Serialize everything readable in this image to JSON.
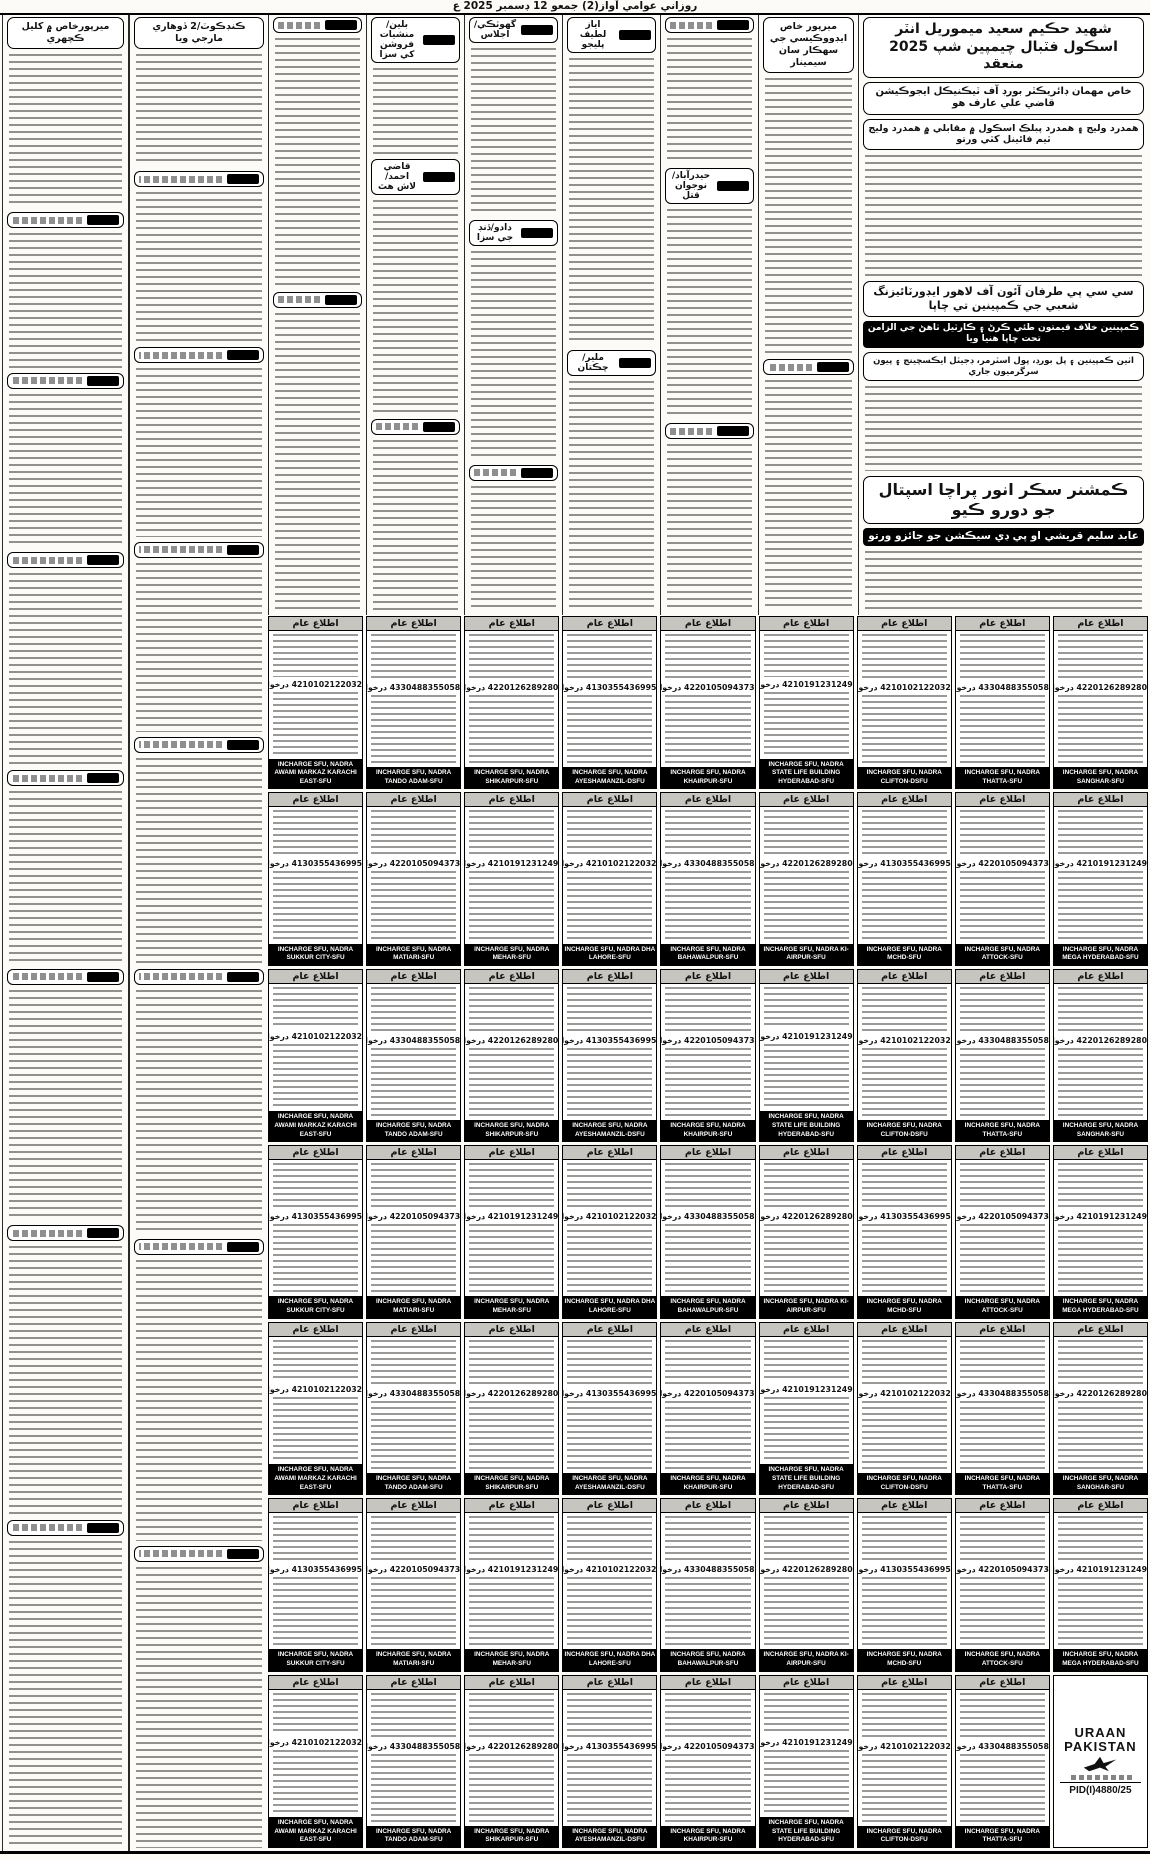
{
  "masthead": {
    "title": "روزاني عوامي آواز(2) جمعو 12 ڊسمبر 2025 ع"
  },
  "colors": {
    "ink": "#121212",
    "paper": "#fcfbf7",
    "notice_header_bg": "#c7c5bf",
    "footer_bg": "#000000"
  },
  "right_top": {
    "headline": "شهيد حڪيم سعيد ميموريل انٽر اسڪول فٽبال چيمپين شپ 2025 منعقد",
    "sub1": "خاص مهمان ڊائريڪٽر بورڊ آف ٽيڪنيڪل ايجوڪيشن قاضي علي عارف هو",
    "sub2": "همدرد وليج ۽ همدرد پبلڪ اسڪول ۾ مقابلي ۾ همدرد وليج ٽيم فائينل کٽي ورتو"
  },
  "right_mid": {
    "headline": "سي سي پي طرفان آئون آف لاهور ايڊورٽائيزنگ شعبي جي ڪمپينين تي چاپا",
    "sub1": "ڪمپينين خلاف قيمتون طئي ڪرڻ ۽ ڪارٽيل ٺاهڻ جي الزامن تحت چاپا هنيا ويا",
    "sub2": "اٺين ڪمپينين ۽ پل بورڊ، پول اسٽرمر، ڊجيٽل ايڪسچينج ۽ پيون سرگرميون جاري"
  },
  "right_bottom": {
    "headline": "ڪمشنر سڪر انور پراچا اسپتال جو دورو ڪيو",
    "sub": "عابد سليم قريشي او پي ڊي سيڪشن جو جائزو ورتو"
  },
  "left_headlines": {
    "col1": "ميرپورخاص ۾ کليل ڪچهري",
    "col2": "ڪنڊڪوٽ/2 ڏوهاري مارجي ويا"
  },
  "mid_labels": {
    "a": "بلين/منشيات فروشن کي سزا",
    "b": "قاضي احمد/لاش هٿ",
    "c": "گهوٽڪي/اجلاس",
    "d": "دادو/ڏنڊ جي سزا",
    "e": "اياز لطيف پليجو",
    "f": "ملير/چڪتان",
    "g": "حيدرآباد/نوجوان قتل",
    "h": "ميرپور خاص ايڊووڪيسي جي سهڪار سان سيمينار"
  },
  "articles": {
    "columns": [
      {
        "x": 2,
        "y": 14,
        "w": 127,
        "h": 1838,
        "first": true,
        "items": [
          {
            "t": "hbox",
            "k": "left_headlines.col1",
            "fs": 9.5
          },
          {
            "t": "g",
            "f": 8
          },
          {
            "t": "tag"
          },
          {
            "t": "g",
            "f": 7
          },
          {
            "t": "tag"
          },
          {
            "t": "g",
            "f": 8
          },
          {
            "t": "tag"
          },
          {
            "t": "g",
            "f": 10
          },
          {
            "t": "tag"
          },
          {
            "t": "g",
            "f": 9
          },
          {
            "t": "tag"
          },
          {
            "t": "g",
            "f": 12
          },
          {
            "t": "tag"
          },
          {
            "t": "g",
            "f": 14
          },
          {
            "t": "tag"
          },
          {
            "t": "g",
            "f": 16
          }
        ]
      },
      {
        "x": 129,
        "y": 14,
        "w": 139,
        "h": 1838,
        "items": [
          {
            "t": "hbox",
            "k": "left_headlines.col2",
            "fs": 9.5
          },
          {
            "t": "g",
            "f": 6
          },
          {
            "t": "tag"
          },
          {
            "t": "g",
            "f": 8
          },
          {
            "t": "tag"
          },
          {
            "t": "g",
            "f": 9
          },
          {
            "t": "tag"
          },
          {
            "t": "g",
            "f": 9
          },
          {
            "t": "tag"
          },
          {
            "t": "g",
            "f": 11
          },
          {
            "t": "tag"
          },
          {
            "t": "g",
            "f": 13
          },
          {
            "t": "tag"
          },
          {
            "t": "g",
            "f": 15
          },
          {
            "t": "tag"
          },
          {
            "t": "g",
            "f": 15
          }
        ]
      },
      {
        "x": 268,
        "y": 14,
        "w": 98,
        "h": 601,
        "items": [
          {
            "t": "tag"
          },
          {
            "t": "g",
            "f": 5
          },
          {
            "t": "tag"
          },
          {
            "t": "g",
            "f": 6
          }
        ]
      },
      {
        "x": 366,
        "y": 14,
        "w": 98,
        "h": 601,
        "items": [
          {
            "t": "sub",
            "k": "mid_labels.a"
          },
          {
            "t": "g",
            "f": 2
          },
          {
            "t": "sub",
            "k": "mid_labels.b"
          },
          {
            "t": "g",
            "f": 5
          },
          {
            "t": "tag"
          },
          {
            "t": "g",
            "f": 4
          }
        ]
      },
      {
        "x": 464,
        "y": 14,
        "w": 98,
        "h": 601,
        "items": [
          {
            "t": "sub",
            "k": "mid_labels.c"
          },
          {
            "t": "g",
            "f": 4
          },
          {
            "t": "sub",
            "k": "mid_labels.d"
          },
          {
            "t": "g",
            "f": 5
          },
          {
            "t": "tag"
          },
          {
            "t": "g",
            "f": 3
          }
        ]
      },
      {
        "x": 562,
        "y": 14,
        "w": 98,
        "h": 601,
        "items": [
          {
            "t": "sub",
            "k": "mid_labels.e"
          },
          {
            "t": "g",
            "f": 5
          },
          {
            "t": "sub",
            "k": "mid_labels.f"
          },
          {
            "t": "g",
            "f": 4
          }
        ]
      },
      {
        "x": 660,
        "y": 14,
        "w": 98,
        "h": 601,
        "items": [
          {
            "t": "tag"
          },
          {
            "t": "g",
            "f": 3
          },
          {
            "t": "sub",
            "k": "mid_labels.g"
          },
          {
            "t": "g",
            "f": 5
          },
          {
            "t": "tag"
          },
          {
            "t": "g",
            "f": 4
          }
        ]
      },
      {
        "x": 758,
        "y": 14,
        "w": 100,
        "h": 601,
        "items": [
          {
            "t": "hbox",
            "k": "mid_labels.h",
            "fs": 9.5
          },
          {
            "t": "g",
            "f": 6
          },
          {
            "t": "tag"
          },
          {
            "t": "g",
            "f": 5
          }
        ]
      },
      {
        "x": 858,
        "y": 14,
        "w": 290,
        "h": 601,
        "items": [
          {
            "t": "hbox",
            "k": "right_top.headline",
            "fs": 14
          },
          {
            "t": "hbox",
            "k": "right_top.sub1",
            "fs": 10
          },
          {
            "t": "hbox",
            "k": "right_top.sub2",
            "fs": 9.5
          },
          {
            "t": "g",
            "f": 10
          },
          {
            "t": "hbox",
            "k": "right_mid.headline",
            "fs": 11
          },
          {
            "t": "bar",
            "k": "right_mid.sub1",
            "fs": 9
          },
          {
            "t": "hbox",
            "k": "right_mid.sub2",
            "fs": 8.5
          },
          {
            "t": "g",
            "f": 7
          },
          {
            "t": "hbox",
            "k": "right_bottom.headline",
            "fs": 16
          },
          {
            "t": "bar",
            "k": "right_bottom.sub",
            "fs": 10.5
          },
          {
            "t": "g",
            "f": 5
          }
        ]
      }
    ]
  },
  "notices": {
    "header_label": "اطلاع عام",
    "request_label": "درخواست وصول",
    "incharge_prefix": "INCHARGE SFU, NADRA",
    "count": 62,
    "numbers": [
      "4210102122032",
      "4330488355058",
      "4220126289280",
      "4130355436995",
      "4220105094373",
      "4210191231249"
    ],
    "locations": [
      "AWAMI MARKAZ KARACHI EAST-SFU",
      "TANDO ADAM-SFU",
      "SHIKARPUR-SFU",
      "AYESHAMANZIL-DSFU",
      "KHAIRPUR-SFU",
      "STATE LIFE BUILDING HYDERABAD-SFU",
      "CLIFTON-DSFU",
      "THATTA-SFU",
      "SANGHAR-SFU",
      "SUKKUR CITY-SFU",
      "MATIARI-SFU",
      "MEHAR-SFU",
      "DHA LAHORE-SFU",
      "BAHAWALPUR-SFU",
      "KI-AIRPUR-SFU",
      "MCHD-SFU",
      "ATTOCK-SFU",
      "MEGA HYDERABAD-SFU"
    ],
    "logo": {
      "line1": "URAAN",
      "line2": "PAKISTAN",
      "pid": "PID(I)4880/25"
    }
  }
}
